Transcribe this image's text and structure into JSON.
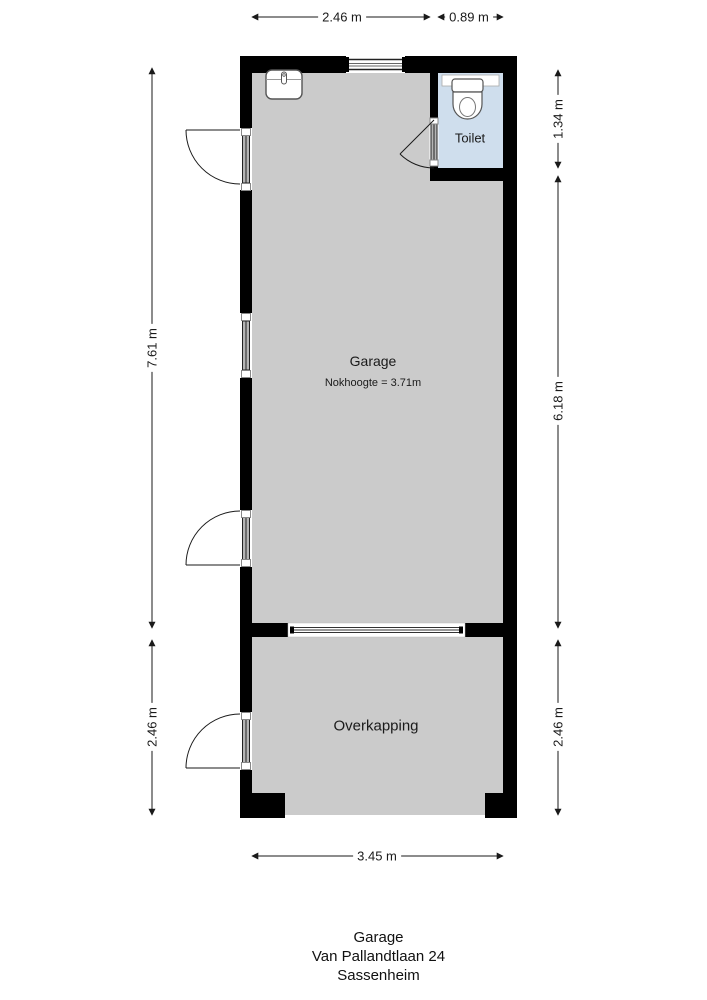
{
  "plan": {
    "rooms": {
      "garage": {
        "label": "Garage",
        "note": "Nokhoogte = 3.71m"
      },
      "toilet": {
        "label": "Toilet"
      },
      "overkapping": {
        "label": "Overkapping"
      }
    },
    "dimensions": {
      "top_garage_width": "2.46 m",
      "top_toilet_width": "0.89 m",
      "left_garage_height": "7.61 m",
      "left_overkapping_height": "2.46 m",
      "right_toilet_height": "1.34 m",
      "right_garage_height": "6.18 m",
      "right_overkapping_height": "2.46 m",
      "bottom_width": "3.45 m"
    },
    "colors": {
      "wall": "#000000",
      "floor": "#cbcbcb",
      "toilet_floor": "#cfdeed",
      "background": "#ffffff",
      "line": "#1a1a1a"
    }
  },
  "footer": {
    "line1": "Garage",
    "line2": "Van Pallandtlaan 24",
    "line3": "Sassenheim"
  }
}
